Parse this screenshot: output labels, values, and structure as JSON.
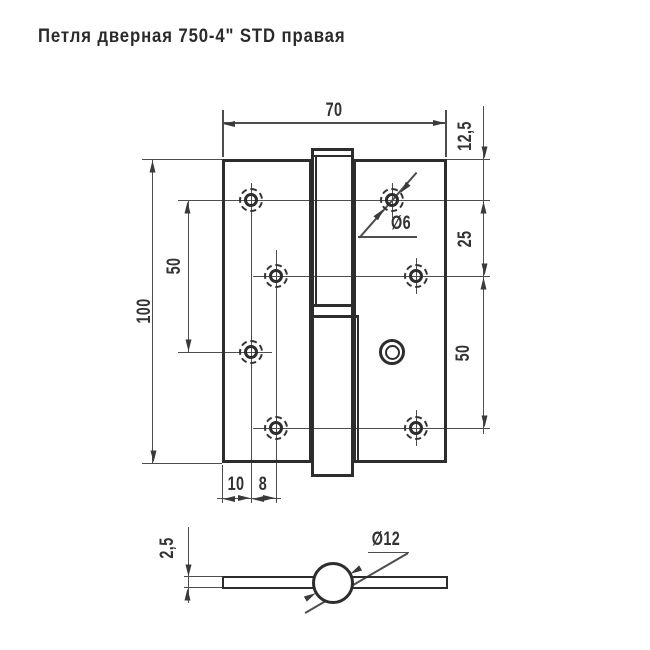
{
  "title": "Петля  дверная 750-4\" STD правая",
  "colors": {
    "outline": "#2d2d2d",
    "thin_line": "#4d4d4d",
    "text": "#333333",
    "background": "#ffffff"
  },
  "front_view": {
    "width_mm": "70",
    "height_mm": "100",
    "corner_to_hole_mm": "12,5",
    "hole_row_spacing_mm": "25",
    "right_hole_span_mm": "50",
    "left_hole_span_mm": "50",
    "edge_to_hole_col_mm": "10",
    "hole_col_stagger_mm": "8",
    "screw_hole_diameter_label": "Ø6"
  },
  "side_view": {
    "leaf_thickness_mm": "2,5",
    "knuckle_diameter_label": "Ø12"
  }
}
